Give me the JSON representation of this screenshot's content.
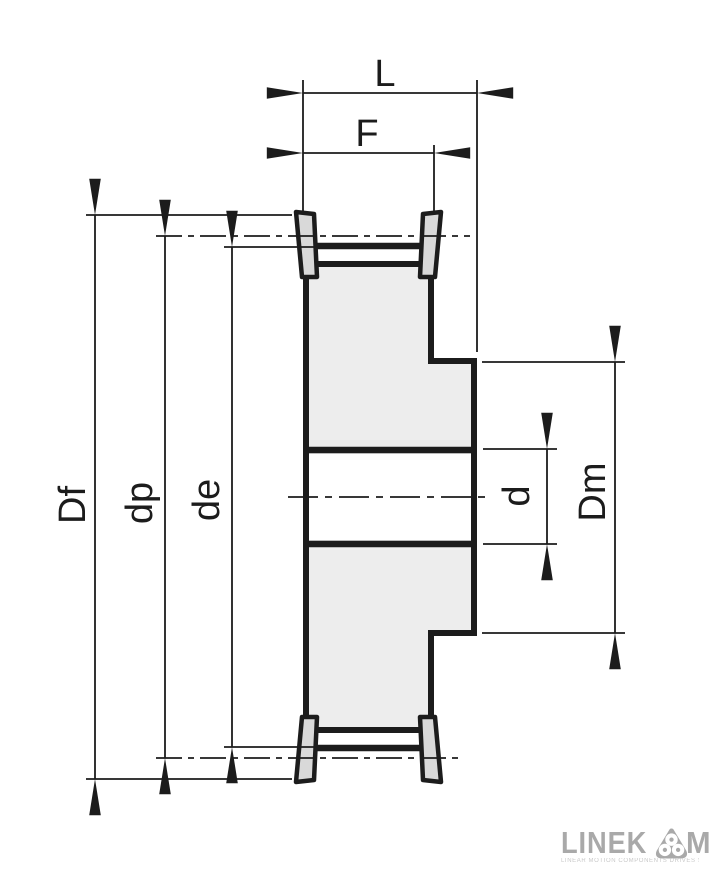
{
  "drawing": {
    "type": "technical-cross-section",
    "subject": "timing belt pulley with flanges and hub",
    "dimensions": {
      "overall_width": {
        "label": "L"
      },
      "belt_width": {
        "label": "F"
      },
      "flange_diameter": {
        "label": "Df"
      },
      "pitch_diameter": {
        "label": "dp"
      },
      "outside_diameter": {
        "label": "de"
      },
      "bore_diameter": {
        "label": "d"
      },
      "hub_diameter": {
        "label": "Dm"
      }
    },
    "colors": {
      "body_fill": "#ededed",
      "flange_fill": "#d9d9d9",
      "line": "#1c1c1c",
      "background": "#ffffff"
    }
  },
  "logo": {
    "wordmark_left": "LINEK",
    "wordmark_right": "M",
    "symbol": "three-pulleys-badge-icon",
    "tagline": "LINEAR MOTION COMPONENTS DRIVES SYSTEMS",
    "color": "#a9a9a9"
  }
}
